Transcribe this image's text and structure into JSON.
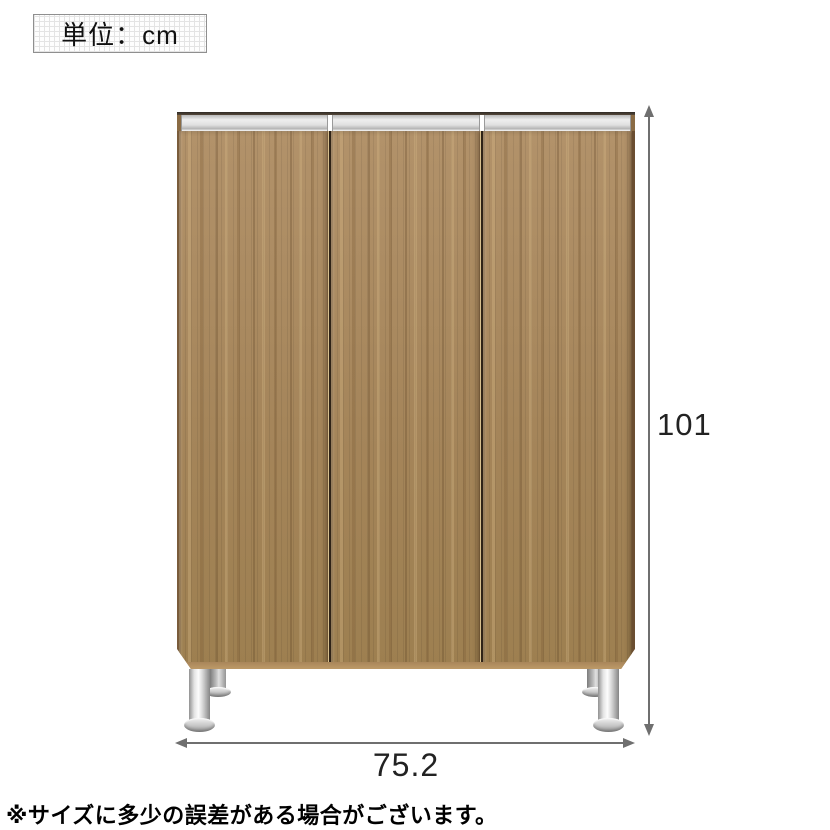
{
  "diagram": {
    "unit_box": {
      "label": "単位：cm"
    },
    "cabinet": {
      "description": "three-door wood-grain cabinet with silver handle rails and chrome legs",
      "door_count": 3
    },
    "dimensions": {
      "unit": "cm",
      "height": {
        "value": "101",
        "orientation": "vertical"
      },
      "width": {
        "value": "75.2",
        "orientation": "horizontal"
      }
    },
    "note": "※サイズに多少の誤差がある場合がございます。",
    "colors": {
      "wood": "#a8895c",
      "wood_edge_dark": "#6b4e31",
      "rail_silver": "#e0e0e0",
      "chrome_leg": "#d6d6d6",
      "dimension_line": "#6f6f6f",
      "text": "#1f1f1f",
      "background": "#ffffff"
    }
  }
}
